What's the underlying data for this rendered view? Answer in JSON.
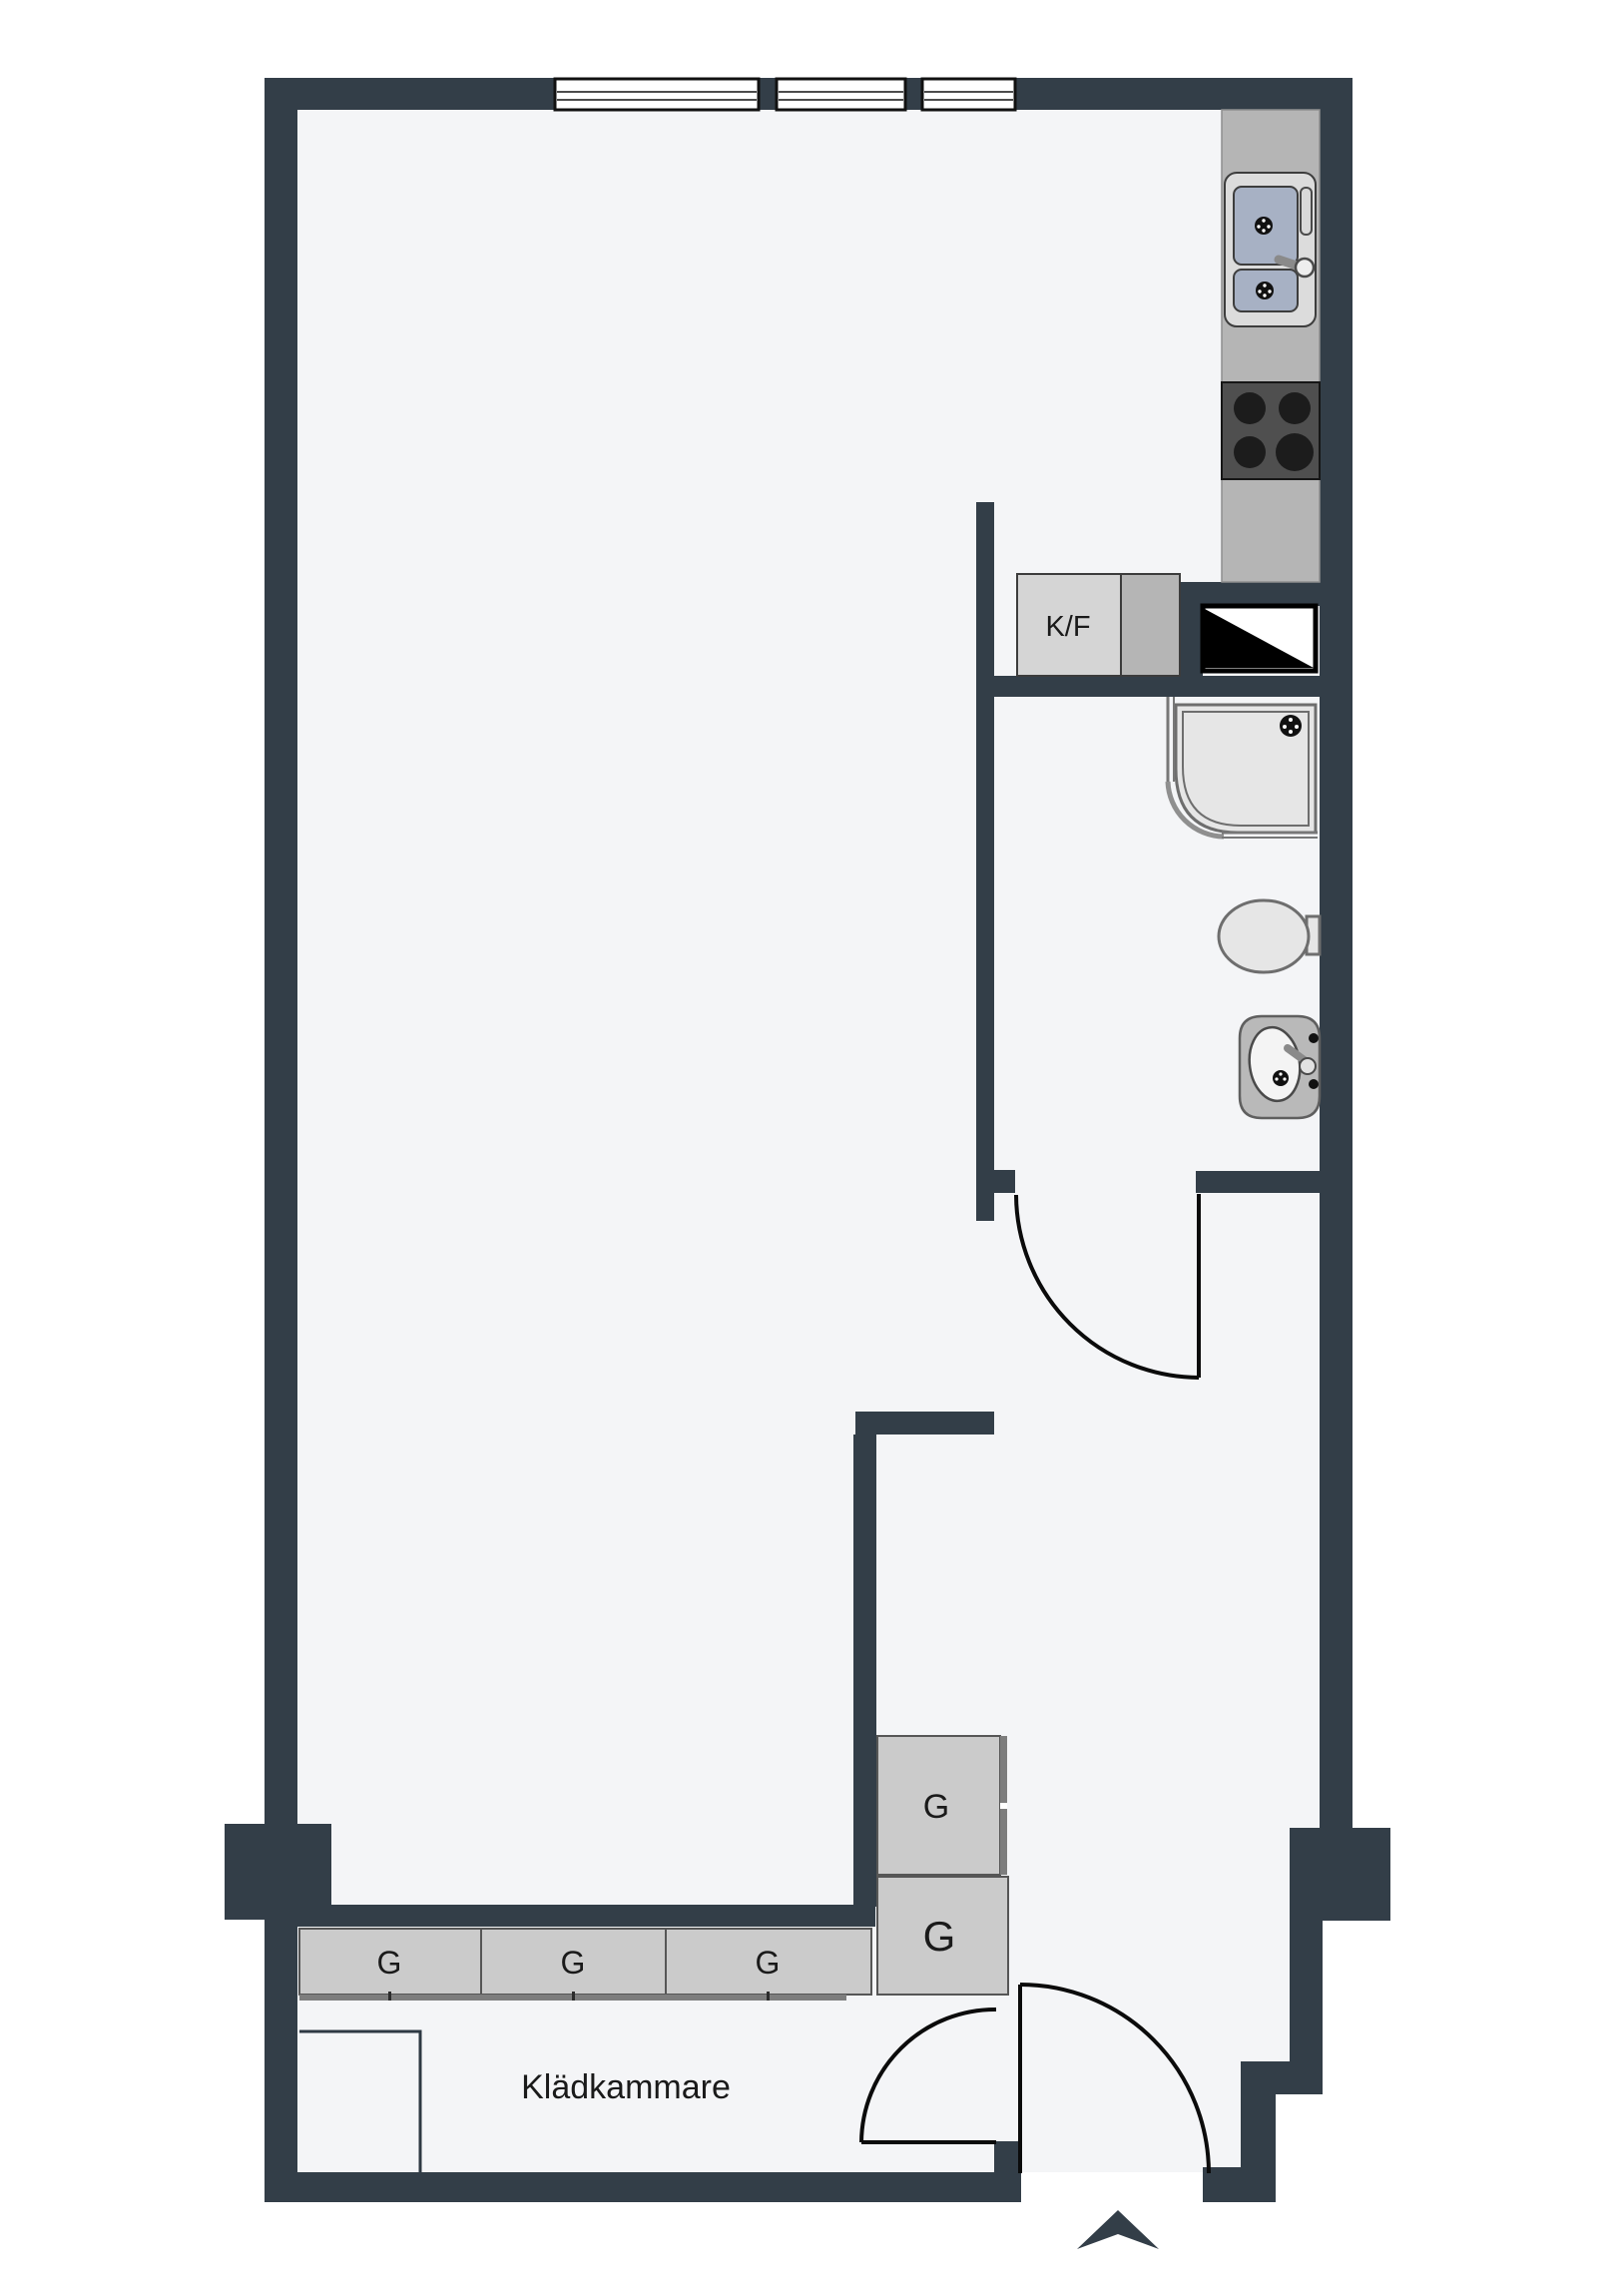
{
  "floorplan": {
    "type": "apartment-floor-plan",
    "labels": {
      "fridge_freezer": "K/F",
      "closet_room": "Klädkammare"
    },
    "wardrobes": [
      {
        "label": "G"
      },
      {
        "label": "G"
      },
      {
        "label": "G"
      },
      {
        "label": "G"
      },
      {
        "label": "G"
      }
    ],
    "fixtures": [
      "kitchen-sink",
      "stove",
      "fridge-freezer-cabinet",
      "shaft-symbol",
      "shower",
      "toilet",
      "washbasin",
      "wardrobes",
      "entry-door",
      "closet-door",
      "bathroom-door",
      "windows",
      "entry-arrow"
    ]
  },
  "colors": {
    "wall": "#333E48",
    "floor": "#F4F5F7",
    "line": "#111111",
    "counter": "#B5B5B5",
    "counterEdge": "#8F8F8F",
    "applianceLight": "#DCDCDC",
    "sinkBasin": "#A7B1C4",
    "stove": "#4F4F4F",
    "burner": "#1C1C1C",
    "cabinetLight": "#D5D5D5",
    "cabinetMid": "#B5B5B5",
    "wardrobe": "#CBCBCB",
    "fixtureFill": "#E6E6E6",
    "fixtureStroke": "#6E6E6E",
    "text": "#1A1A1A"
  }
}
